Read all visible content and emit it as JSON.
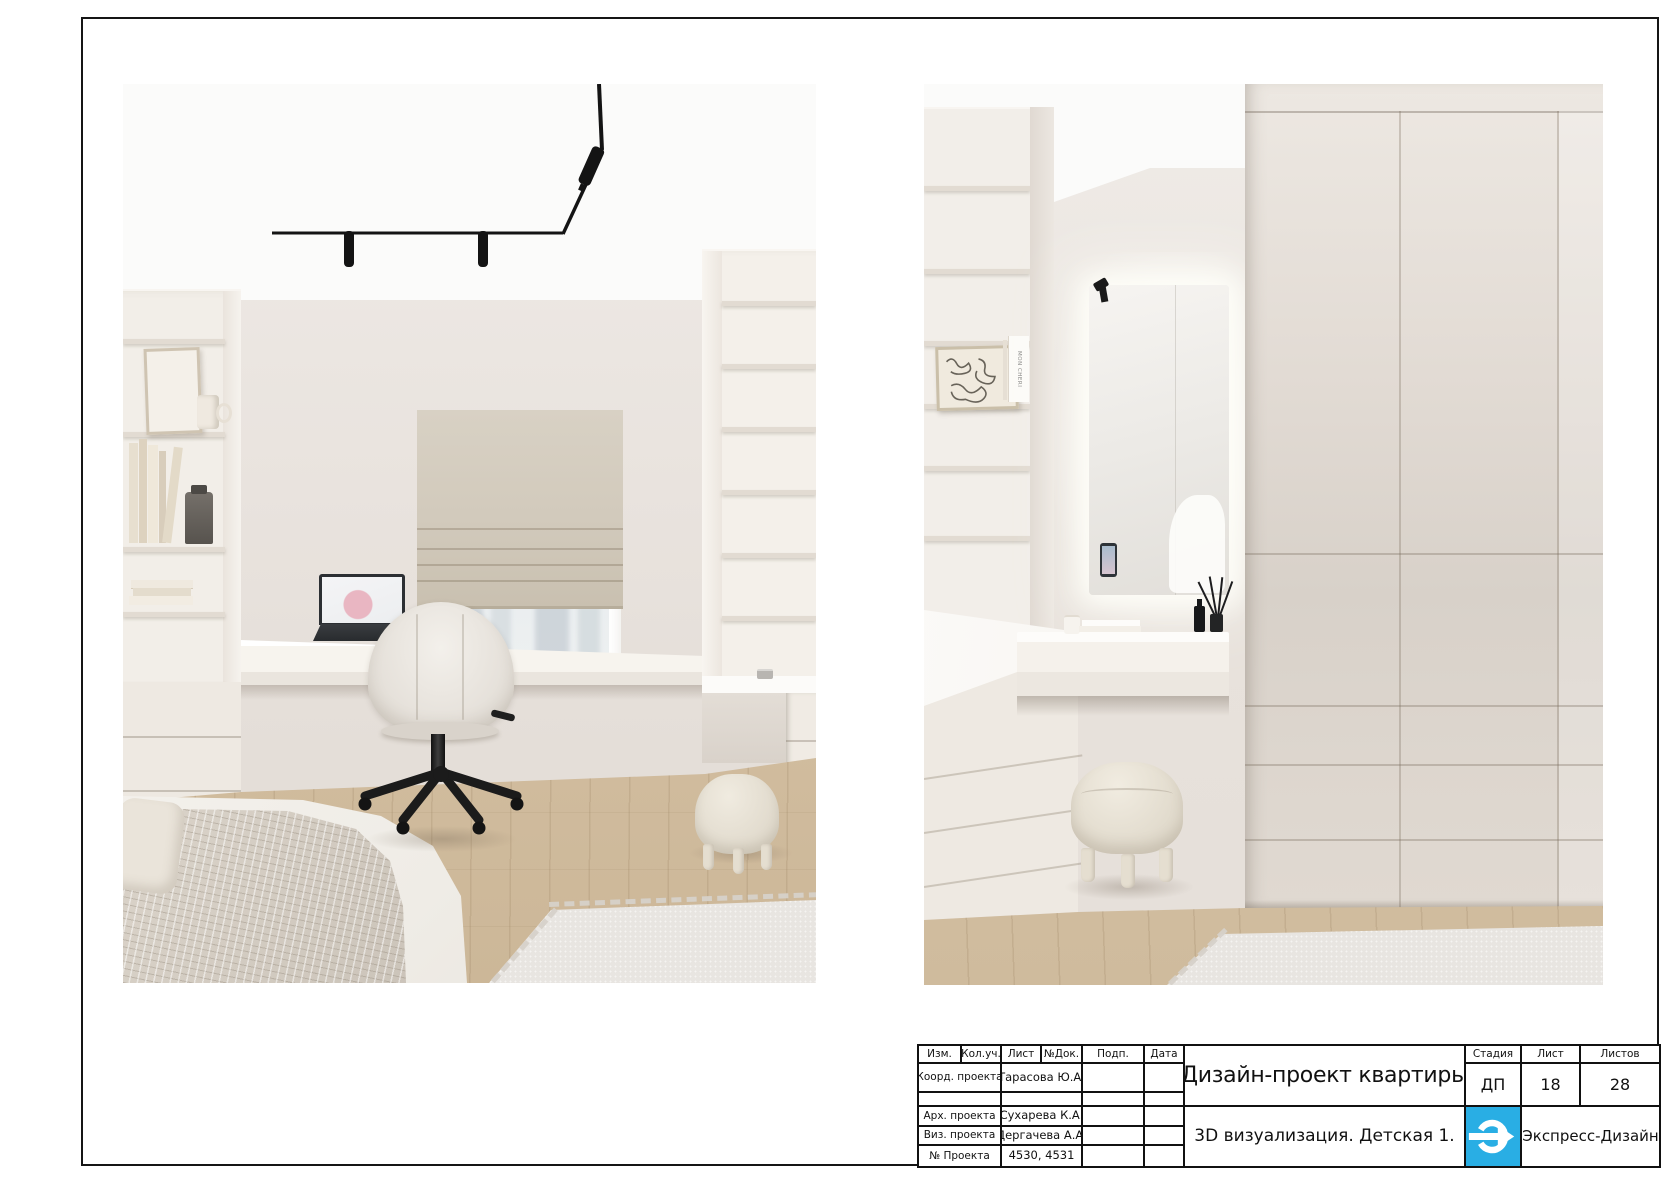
{
  "page": {
    "background": "#ffffff",
    "frame_color": "#151515"
  },
  "palette": {
    "wall": "#e9e3dd",
    "ceiling": "#fbfbfa",
    "wood_floor": "#d5c1a4",
    "rug": "#e7e4e0",
    "roman_blind": "#d3cabb",
    "black_fixtures": "#161616"
  },
  "panels": {
    "right": {
      "book_spine_text": "MON CHERI"
    }
  },
  "title_block": {
    "headers": [
      "Изм.",
      "Кол.уч.",
      "Лист",
      "№Док.",
      "Подп.",
      "Дата"
    ],
    "rows": [
      {
        "label": "Коорд. проекта",
        "value": "Тарасова Ю.А."
      },
      {
        "label": "",
        "value": ""
      },
      {
        "label": "Арх. проекта",
        "value": "Сухарева К.А."
      },
      {
        "label": "Виз. проекта",
        "value": "Дергачева А.А."
      },
      {
        "label": "№ Проекта",
        "value": "4530, 4531"
      }
    ],
    "project_title": "Дизайн-проект квартиры",
    "sheet_title": "3D визуализация. Детская 1.",
    "stage_label": "Стадия",
    "stage_value": "ДП",
    "sheet_label": "Лист",
    "sheet_value": "18",
    "sheets_label": "Листов",
    "sheets_value": "28",
    "company": "Экспресс-Дизайн",
    "logo": {
      "color": "#29aee4",
      "icon": "e-arrow-right-icon"
    }
  }
}
